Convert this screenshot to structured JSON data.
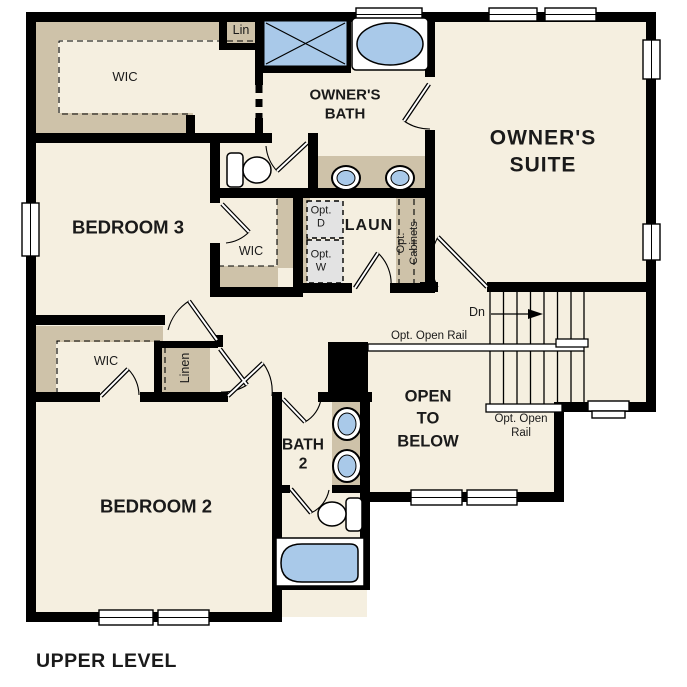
{
  "title": "UPPER LEVEL",
  "colors": {
    "wall": "#000000",
    "floor": "#f5efe0",
    "shelf": "#cec2a9",
    "blue": "#a9c9e9",
    "appliance": "#e3e3e3"
  },
  "labels": {
    "upper_level": "UPPER LEVEL",
    "owners_suite": "OWNER'S\nSUITE",
    "owners_bath": "OWNER'S\nBATH",
    "bedroom3": "BEDROOM 3",
    "bedroom2": "BEDROOM 2",
    "bath2": "BATH\n2",
    "laundry": "LAUN",
    "wic_owners": "WIC",
    "wic_bedroom3": "WIC",
    "wic_bedroom2": "WIC",
    "linen_small": "Lin",
    "linen": "Linen",
    "opt_dryer": "Opt.\nD",
    "opt_washer": "Opt.\nW",
    "opt_cabinets": "Opt.\nCabinets",
    "stairs_down": "Dn",
    "opt_open_rail_upper": "Opt. Open Rail",
    "opt_open_rail_lower": "Opt. Open\nRail",
    "open_to_below": "OPEN\nTO\nBELOW"
  }
}
